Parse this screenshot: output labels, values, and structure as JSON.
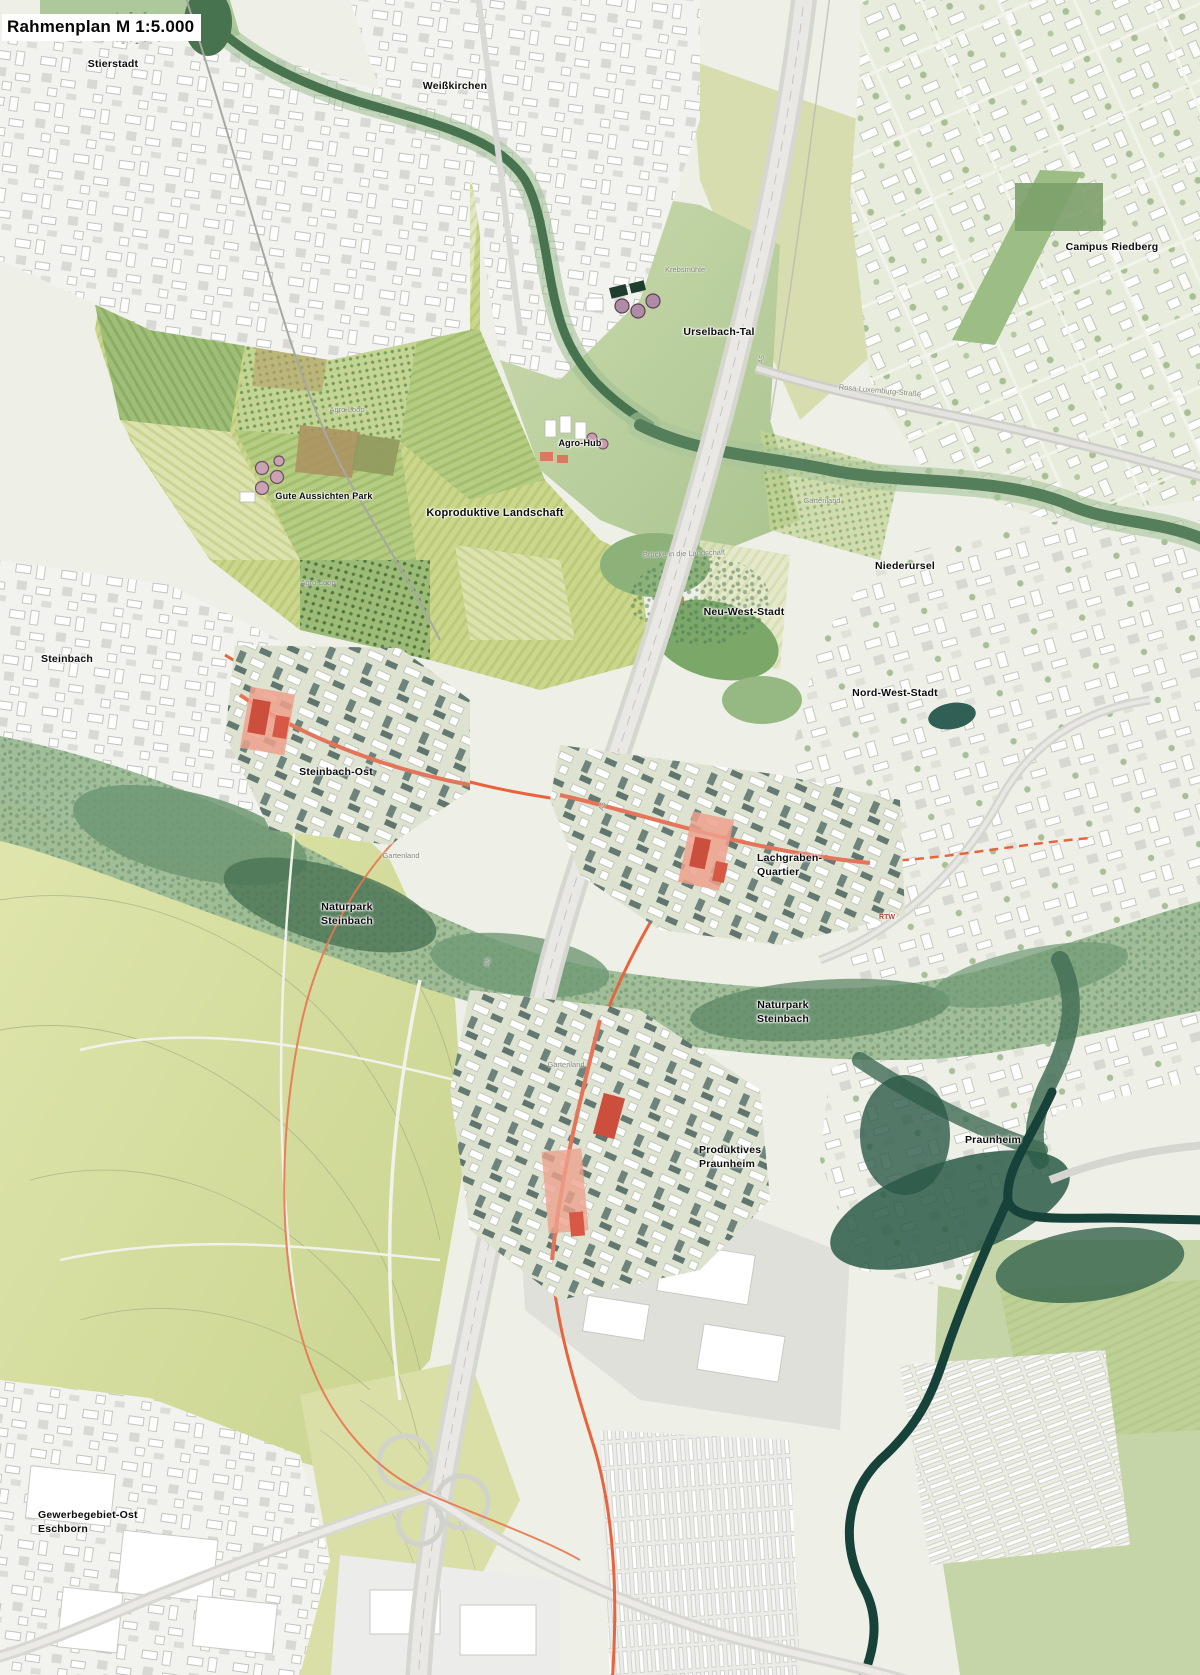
{
  "map": {
    "title": "Rahmenplan M 1:5.000",
    "labels": {
      "stierstadt": "Stierstadt",
      "weisskirchen": "Weißkirchen",
      "campus_riedberg": "Campus Riedberg",
      "urselbach_tal": "Urselbach-Tal",
      "agro_hub": "Agro-Hub",
      "gute_aussichten_park": "Gute Aussichten Park",
      "koproduktive_landschaft": "Koproduktive Landschaft",
      "niederursel": "Niederursel",
      "neu_west_stadt": "Neu-West-Stadt",
      "nord_west_stadt": "Nord-West-Stadt",
      "steinbach": "Steinbach",
      "steinbach_ost": "Steinbach-Ost",
      "lachgraben_line1": "Lachgraben-",
      "lachgraben_line2": "Quartier",
      "naturpark_line1": "Naturpark",
      "naturpark_line2": "Steinbach",
      "praunheim": "Praunheim",
      "produktives_line1": "Produktives",
      "produktives_line2": "Praunheim",
      "gewerbegebiet_line1": "Gewerbegebiet-Ost",
      "gewerbegebiet_line2": "Eschborn",
      "rosa_luxemburg_strasse": "Rosa-Luxemburg-Straße",
      "krebsmuehle": "Krebsmühle",
      "agro_loop": "Agro-Loop",
      "gartenland": "Gartenland",
      "bruecke_landschaft": "Brücke in die Landschaft",
      "rtw": "RTW",
      "a5": "A5"
    },
    "colors": {
      "rtw_line": "#e8643e",
      "development_red": "#cc4f3d",
      "development_salmon": "#eda18d",
      "field_yellow_green": "#cbd78c",
      "naturpark_green": "#9cbb95",
      "forest_dark": "#48734f",
      "river_dark": "#16423a",
      "urban_white": "#f2f2ee",
      "highway_gray": "#d7d7d2"
    }
  }
}
